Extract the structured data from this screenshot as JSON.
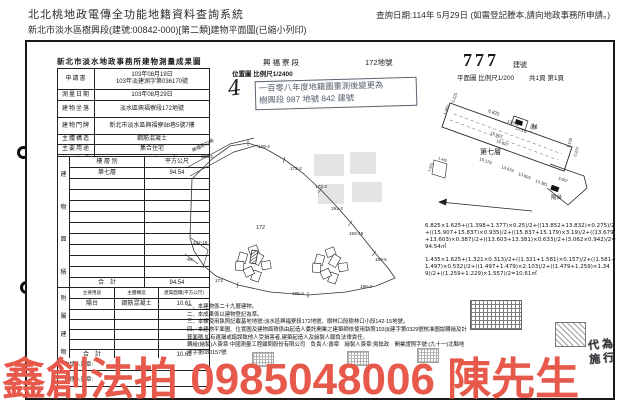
{
  "header": {
    "system_title": "北北桃地政電傳全功能地籍資料查詢系統",
    "query_date": "查詢日期:114年 5月29日 (如需登記謄本,請向地政事務所申請。)",
    "doc_line": "新北市淡水區樹興段(建號:00842-000)[第二類]建物平面圖(已縮小列印)"
  },
  "form": {
    "title": "新北市淡水地政事務所建物測量成果圖",
    "section": "興福寮段",
    "land_no": "172地號",
    "building_no": "777",
    "building_no_unit": "建號",
    "plan_scale": "平面圖 比例尺1/200",
    "page_info": "共1頁 第1頁",
    "location_map_label": "位置圖 比例尺1/2400",
    "handwritten_mark": "4",
    "resurvey_stamp_line1": "一百零八年度地籍圖重測後變更為",
    "resurvey_stamp_line2": "樹興段 987 地號 842 建號",
    "info_rows": [
      {
        "label": "申請書",
        "lines": [
          "103年08月19日",
          "103年淡建測字第036170號"
        ]
      },
      {
        "label": "測量日期",
        "lines": [
          "103年08月29日"
        ]
      },
      {
        "label": "建物坐落",
        "lines": [
          "淡水區興福寮段172地號"
        ]
      },
      {
        "label": "建物門牌",
        "lines": [
          "新北市淡水區興福寮98巷5號7樓"
        ]
      },
      {
        "label": "主體構造",
        "lines": [
          "鋼筋混凝土"
        ]
      },
      {
        "label": "主要用途",
        "lines": [
          "集合住宅"
        ]
      },
      {
        "label": "使用執照",
        "lines": [
          "103淡建字第0329號"
        ]
      }
    ],
    "area_table": {
      "side_label": "建物面積",
      "col_floor": "樓 層 別",
      "col_area": "平方公尺",
      "floor": "第七層",
      "floor_area": "94.54",
      "empty_rows": 9,
      "total_label": "合　計",
      "total": "94.54"
    },
    "annex_table": {
      "side_label": "附屬建物",
      "col_use": "主要用途",
      "col_structure": "主體構造",
      "col_area": "建築面積(平方公尺)",
      "use": "陽台",
      "structure": "鋼筋混凝土",
      "area": "10.61",
      "empty_rows": 4,
      "total_label": "合　計",
      "total": "10.61"
    },
    "sign_rows": [
      "申請人簽章:",
      "代理人簽章:"
    ]
  },
  "map": {
    "labels": [
      {
        "t": "興福寮22巷",
        "x": 191,
        "y": 150,
        "r": -27,
        "s": 4.6
      },
      {
        "t": "186-4",
        "x": 199,
        "y": 156,
        "r": 0,
        "s": 4.6
      },
      {
        "t": "189-4",
        "x": 256,
        "y": 146,
        "r": 0,
        "s": 4.6
      },
      {
        "t": "173-2",
        "x": 288,
        "y": 168,
        "r": 0,
        "s": 4.6
      },
      {
        "t": "173-3",
        "x": 313,
        "y": 186,
        "r": 0,
        "s": 4.6
      },
      {
        "t": "191-3",
        "x": 329,
        "y": 208,
        "r": 0,
        "s": 4.6
      },
      {
        "t": "193-15",
        "x": 347,
        "y": 233,
        "r": 0,
        "s": 4.6
      },
      {
        "t": "142-16",
        "x": 191,
        "y": 242,
        "r": 0,
        "s": 4.6
      },
      {
        "t": "-94",
        "x": 184,
        "y": 259,
        "r": 0,
        "s": 4.6
      },
      {
        "t": "172",
        "x": 254,
        "y": 227,
        "r": 0,
        "s": 5.4
      },
      {
        "t": "173",
        "x": 213,
        "y": 280,
        "r": 0,
        "s": 4.6
      },
      {
        "t": "185-4",
        "x": 290,
        "y": 293,
        "r": 0,
        "s": 4.6
      },
      {
        "t": "196-3",
        "x": 358,
        "y": 286,
        "r": 0,
        "s": 4.6
      },
      {
        "t": "189-5",
        "x": 373,
        "y": 259,
        "r": 0,
        "s": 4.6
      }
    ]
  },
  "plan": {
    "labels": [
      {
        "t": "6.825",
        "x": 486,
        "y": 110,
        "r": 20,
        "s": 4.6
      },
      {
        "t": "0.225",
        "x": 452,
        "y": 101,
        "r": -70,
        "s": 4
      },
      {
        "t": "1.683",
        "x": 444,
        "y": 113,
        "r": -70,
        "s": 4
      },
      {
        "t": "13.852",
        "x": 505,
        "y": 120,
        "r": 20,
        "s": 4
      },
      {
        "t": "13.832",
        "x": 513,
        "y": 127,
        "r": 20,
        "s": 4
      },
      {
        "t": "15.907",
        "x": 488,
        "y": 132,
        "r": 20,
        "s": 4.2
      },
      {
        "t": "15.837",
        "x": 494,
        "y": 140,
        "r": 20,
        "s": 4.2
      },
      {
        "t": "1.398",
        "x": 529,
        "y": 131,
        "r": -70,
        "s": 3.8
      },
      {
        "t": "第七層",
        "x": 478,
        "y": 152,
        "r": 0,
        "s": 7
      },
      {
        "t": "15.179",
        "x": 477,
        "y": 158,
        "r": 20,
        "s": 4.2
      },
      {
        "t": "13.679",
        "x": 499,
        "y": 166,
        "r": 20,
        "s": 4.2
      },
      {
        "t": "13.603",
        "x": 516,
        "y": 173,
        "r": 20,
        "s": 4.2
      },
      {
        "t": "13.381",
        "x": 533,
        "y": 180,
        "r": 20,
        "s": 4.2
      },
      {
        "t": "1.105",
        "x": 567,
        "y": 146,
        "r": -70,
        "s": 4
      },
      {
        "t": "0.377",
        "x": 574,
        "y": 155,
        "r": -70,
        "s": 4
      },
      {
        "t": "3.062",
        "x": 556,
        "y": 177,
        "r": 20,
        "s": 3.8
      },
      {
        "t": "梯",
        "x": 530,
        "y": 127,
        "r": 0,
        "s": 5.5
      },
      {
        "t": "陽台",
        "x": 549,
        "y": 197,
        "r": 0,
        "s": 5.5
      },
      {
        "t": "1.435",
        "x": 436,
        "y": 157,
        "r": 20,
        "s": 3.6
      },
      {
        "t": "1.625",
        "x": 428,
        "y": 170,
        "r": -70,
        "s": 3.6
      }
    ]
  },
  "formulas": {
    "main": "6.825×1.625+((1.398+1.377)×0.25)/2+((13.852+13.832)×0.275)/2+((15.907+15.837)×0.935)/2+((15.837+15.179)×3.19)/2+((13.679+13.603)×0.387)/2+((13.603+13.381)×0.633)/2+(3.062×0.942)/2=94.54㎡",
    "annex": "1.435×1.625+(1.321×0.313)/2+((1.321+1.581)×0.157)/2+((1.581+1.497)×0.532)/2+((1.497+1.479)×2.103)/2+((1.479+1.259)×1.349)/2+((1.259+1.229)×1.557)/2=10.61㎡"
  },
  "notes": [
    "一、本建物係二十九層建物。",
    "二、本成果係以建物登記為準。",
    "三、本棟使用執照記載基地地號:淡水區興福寮段172地號、樹林口段樹林口小段142-15地號。",
    "四、本建物平面圖、位置圖及建物面積係由起造人委託開業之建築師依使用執照103淡建字第0329號核准圖說轉繪及計算面積,如有遺漏或錯誤致他人受損害者,建築起造人及繪製人願負法律責任。",
    "轉繪(繪製)人簽章:中國測量工程顧問股份有限公司　負責人:壽章　繪製人簽章:吳鉉政　開業證照字號:(九十一)北縣地測字第080157號"
  ],
  "seals": {
    "agent": "代為施行"
  },
  "watermark": {
    "text": "鑫創法拍 0985048006 陳先生",
    "color": "#e7594a"
  }
}
